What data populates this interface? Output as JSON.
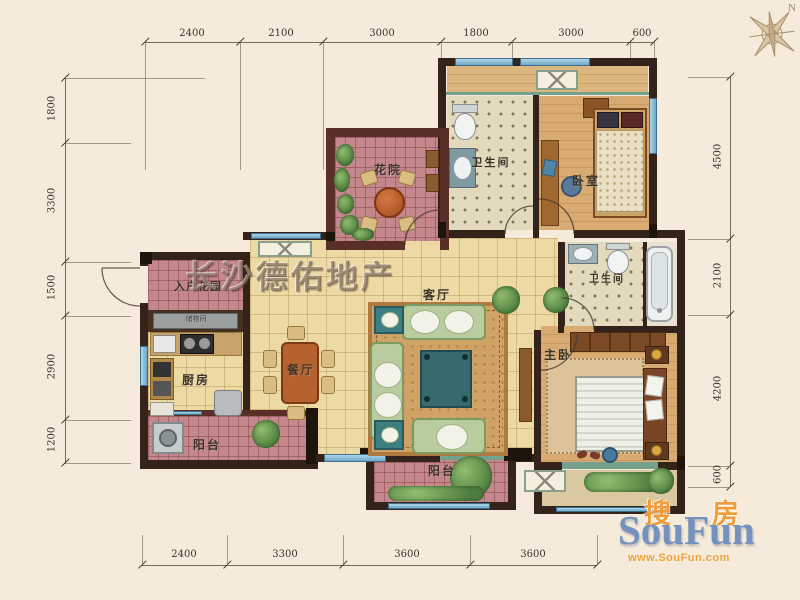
{
  "watermark": "长沙德佑地产",
  "compass": {
    "north": "N"
  },
  "logo": {
    "zh_left": "搜",
    "zh_right": "房",
    "name": "SouFun",
    "url": "www.SouFun.com"
  },
  "rooms": {
    "flower_court": "花院",
    "bath_top": "卫生间",
    "bedroom": "卧室",
    "entry_garden": "入户花园",
    "storage": "储物间",
    "kitchen": "厨房",
    "dining": "餐厅",
    "living": "客厅",
    "bath_master": "卫生间",
    "master_bedroom": "主卧",
    "balcony_left": "阳台",
    "balcony_bottom": "阳台"
  },
  "dims": {
    "top": [
      "2400",
      "2100",
      "3000",
      "1800",
      "3000",
      "600"
    ],
    "bottom": [
      "2400",
      "3300",
      "3600",
      "3600"
    ],
    "left": [
      "1800",
      "3300",
      "1500",
      "2900",
      "1200"
    ],
    "right": [
      "4500",
      "2100",
      "4200",
      "600"
    ]
  },
  "colors": {
    "wall": "#33231a",
    "courtyard_wall": "#5a2f28",
    "tile": "#ecd9a4",
    "pink_tile": "#c4878c",
    "window_blue": "#8fc3e0",
    "logo_blue": "#7492bd",
    "logo_orange": "#f0a23c"
  }
}
